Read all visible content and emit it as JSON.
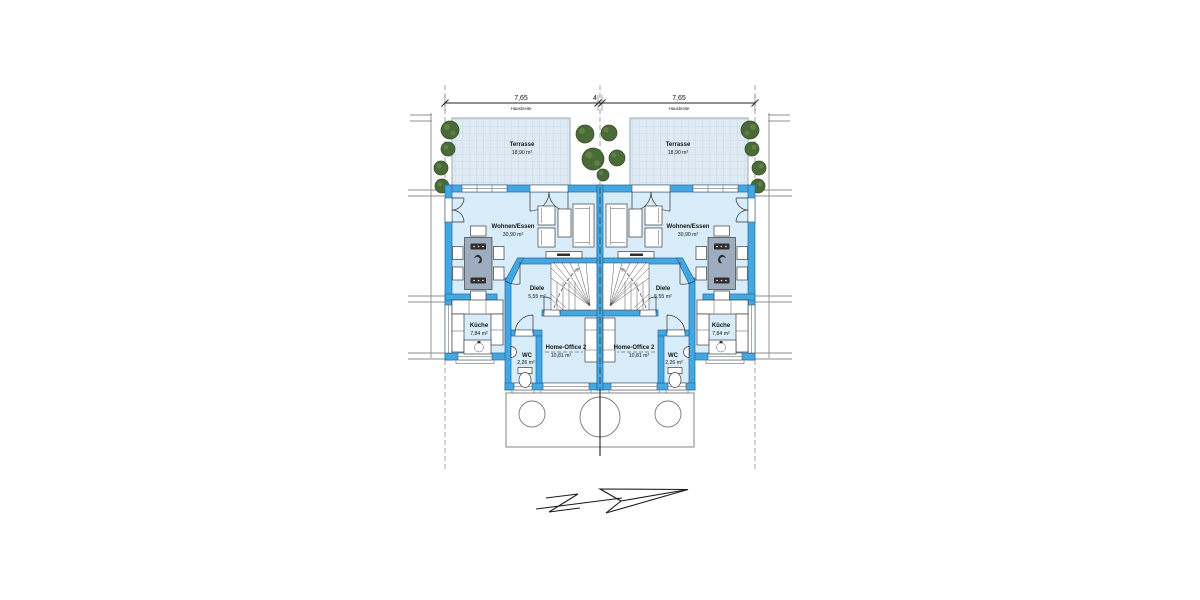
{
  "colors": {
    "wall": "#45a7e1",
    "wall_stroke": "#1a6aa3",
    "floor": "#d8ecfa",
    "terrace": "#e0eaf2",
    "terrace_grid": "#b7cedf",
    "tree": "#4a6a38",
    "tree_dark": "#324c26",
    "tree_light": "#69884d",
    "table": "#9dadbf"
  },
  "dimension_row": {
    "left_width": "7,65",
    "left_label": "Hausbreite",
    "gap": "4",
    "right_width": "7,65",
    "right_label": "Hausbreite"
  },
  "rooms": {
    "terrasse": {
      "name": "Terrasse",
      "area": "18,90 m²"
    },
    "wohnen_essen": {
      "name": "Wohnen/Essen",
      "area": "30,90 m²"
    },
    "diele": {
      "name": "Diele",
      "area": "5,55 m²"
    },
    "kueche": {
      "name": "Küche",
      "area": "7,84 m²"
    },
    "wc": {
      "name": "WC",
      "area": "2,26 m²"
    },
    "home_office": {
      "name": "Home-Office 2",
      "area": "10,81 m²"
    }
  }
}
